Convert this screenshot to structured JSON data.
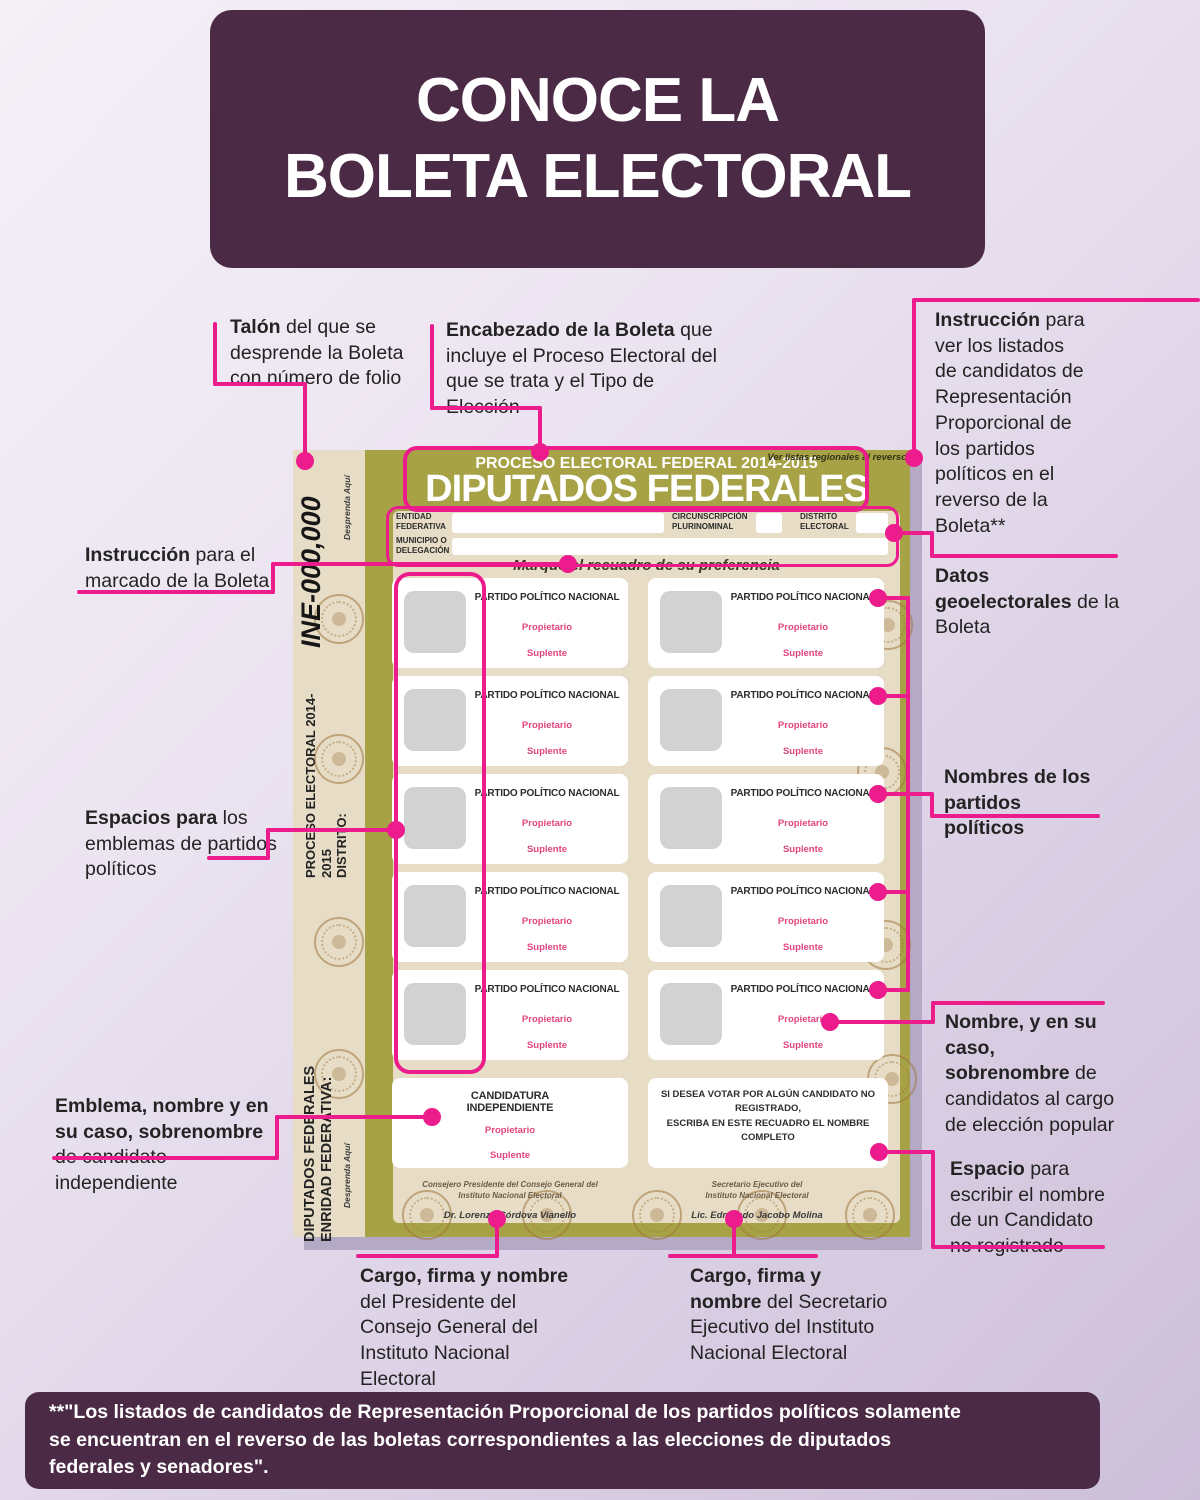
{
  "colors": {
    "accent_pink": "#ec1c8d",
    "card_purple": "#4b2a46",
    "ballot_olive": "#a6a245",
    "ballot_beige": "#e7ddc6",
    "party_pink_text": "#e0457f"
  },
  "title": {
    "line1": "CONOCE LA",
    "line2": "BOLETA ELECTORAL"
  },
  "callouts": {
    "talon": {
      "bold": "Talón",
      "rest": " del que se desprende la Boleta con número de folio"
    },
    "encabezado": {
      "bold": "Encabezado de la Boleta",
      "rest": " que incluye el Proceso Electoral del que se trata y el Tipo de Elección"
    },
    "instruccion_listados": {
      "bold": "Instrucción",
      "rest": " para ver los listados de candidatos de Representación Proporcional de los partidos políticos en el reverso de la Boleta**"
    },
    "instruccion_marcado": {
      "bold": "Instrucción",
      "rest": " para el marcado de la Boleta"
    },
    "datos_geoelectorales": {
      "bold": "Datos geoelectorales",
      "rest": " de la Boleta"
    },
    "espacios_emblemas": {
      "bold": "Espacios para",
      "rest": " los emblemas de partidos políticos"
    },
    "nombres_partidos": {
      "bold": "Nombres de los partidos políticos",
      "rest": ""
    },
    "nombre_sobrenombre": {
      "bold": "Nombre, y en su caso, sobrenombre",
      "rest": " de candidatos al cargo de elección popular"
    },
    "emblema_independiente": {
      "bold": "Emblema, nombre y en su caso, sobrenombre",
      "rest": " de candidato independiente"
    },
    "espacio_no_registrado": {
      "bold": "Espacio",
      "rest": " para escribir el nombre de un Candidato no registrado"
    },
    "cargo_presidente": {
      "bold": "Cargo, firma y nombre",
      "rest": " del Presidente del Consejo General del Instituto Nacional Electoral"
    },
    "cargo_secretario": {
      "bold": "Cargo, firma y nombre",
      "rest": " del Secretario Ejecutivo del Instituto Nacional Electoral"
    }
  },
  "ballot": {
    "folio": "INE-000,000",
    "detach_note": "Desprenda Aquí",
    "side_upper": "PROCESO ELECTORAL 2014-2015\nDISTRITO:",
    "side_lower": "DIPUTADOS FEDERALES\nENRIDAD FEDERATIVA:",
    "header_line1": "PROCESO ELECTORAL FEDERAL 2014-2015",
    "header_line2": "DIPUTADOS FEDERALES",
    "reverse_note": "Ver listas regionales al reverso",
    "fields": {
      "entidad_label": "ENTIDAD\nFEDERATIVA",
      "circunscripcion_label": "CIRCUNSCRIPCIÓN\nPLURINOMINAL",
      "distrito_label": "DISTRITO\nELECTORAL",
      "municipio_label": "MUNICIPIO O\nDELEGACIÓN"
    },
    "mark_instruction": "Marque el recuadro de su preferencia",
    "party_box": {
      "title": "PARTIDO POLÍTICO NACIONAL",
      "propietario": "Propietario",
      "suplente": "Suplente"
    },
    "party_rows": 5,
    "independent_box": {
      "title": "CANDIDATURA\nINDEPENDIENTE",
      "propietario": "Propietario",
      "suplente": "Suplente"
    },
    "write_in_box": "SI DESEA VOTAR POR ALGÚN CANDIDATO NO REGISTRADO,\nESCRIBA EN ESTE RECUADRO EL NOMBRE COMPLETO",
    "signatures": {
      "left_role": "Consejero Presidente del Consejo General del\nInstituto Nacional Electoral",
      "left_name": "Dr. Lorenzo Córdova Vianello",
      "right_role": "Secretario Ejecutivo del\nInstituto Nacional Electoral",
      "right_name": "Lic. Edmundo Jacobo Molina"
    }
  },
  "footer": "**\"Los listados de candidatos de Representación Proporcional de los partidos políticos solamente se encuentran en el reverso de las boletas correspondientes a las elecciones de diputados federales y senadores\"."
}
